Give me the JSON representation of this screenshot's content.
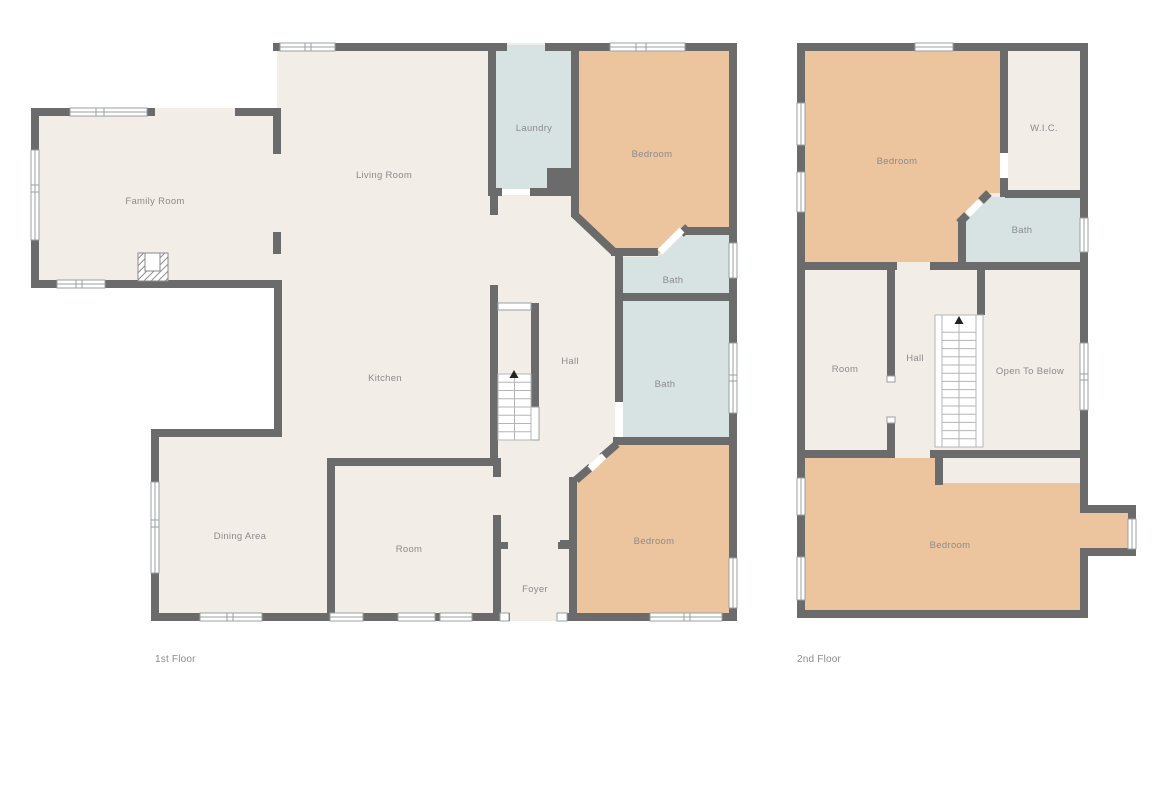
{
  "palette": {
    "background": "#ffffff",
    "wall": "#6b6b6b",
    "floor": "#f3ede7",
    "bedroom_fill": "#ecc49e",
    "bath_fill": "#d7e3e3",
    "window_stroke": "#9aa0a0",
    "label": "#8b8b8b",
    "stair_line": "#b5b5b5"
  },
  "glyphs": {
    "window": "window-glyph",
    "door": "door-opening",
    "stairs_arrow": "up-triangle",
    "fireplace": "hatched-fireplace-box"
  },
  "floors": [
    {
      "caption": "1st Floor",
      "rooms": [
        {
          "id": "family-room",
          "label": "Family Room"
        },
        {
          "id": "living-room",
          "label": "Living Room"
        },
        {
          "id": "laundry",
          "label": "Laundry"
        },
        {
          "id": "bedroom-top",
          "label": "Bedroom"
        },
        {
          "id": "bath-upper",
          "label": "Bath"
        },
        {
          "id": "bath-lower",
          "label": "Bath"
        },
        {
          "id": "hall",
          "label": "Hall"
        },
        {
          "id": "kitchen",
          "label": "Kitchen"
        },
        {
          "id": "dining-area",
          "label": "Dining Area"
        },
        {
          "id": "room",
          "label": "Room"
        },
        {
          "id": "foyer",
          "label": "Foyer"
        },
        {
          "id": "bedroom-bottom",
          "label": "Bedroom"
        }
      ]
    },
    {
      "caption": "2nd Floor",
      "rooms": [
        {
          "id": "bedroom-top",
          "label": "Bedroom"
        },
        {
          "id": "wic",
          "label": "W.I.C."
        },
        {
          "id": "bath",
          "label": "Bath"
        },
        {
          "id": "room",
          "label": "Room"
        },
        {
          "id": "hall",
          "label": "Hall"
        },
        {
          "id": "open-to-below",
          "label": "Open To Below"
        },
        {
          "id": "bedroom-bottom",
          "label": "Bedroom"
        }
      ]
    }
  ]
}
